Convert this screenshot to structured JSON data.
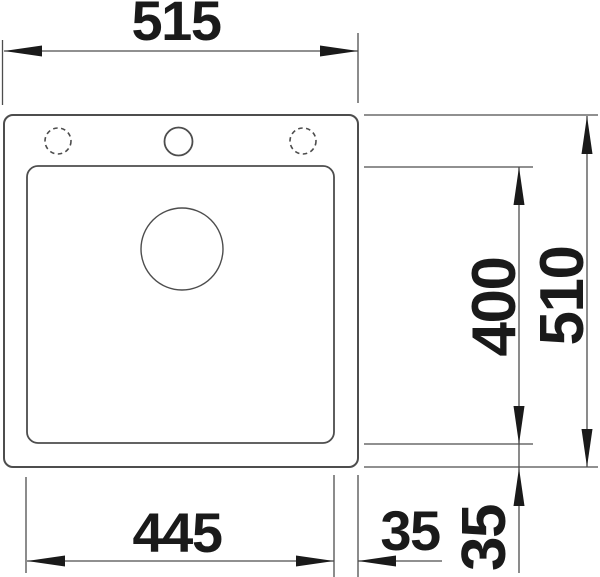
{
  "drawing": {
    "title": "sink-top-view-dimension-drawing",
    "dimensions": {
      "overall_width": "515",
      "overall_height": "510",
      "bowl_width": "445",
      "bowl_height": "400",
      "offset_right": "35",
      "offset_bottom": "35"
    },
    "colors": {
      "line": "#4d4d4d",
      "text": "#1a1a1a",
      "background": "#ffffff"
    }
  }
}
